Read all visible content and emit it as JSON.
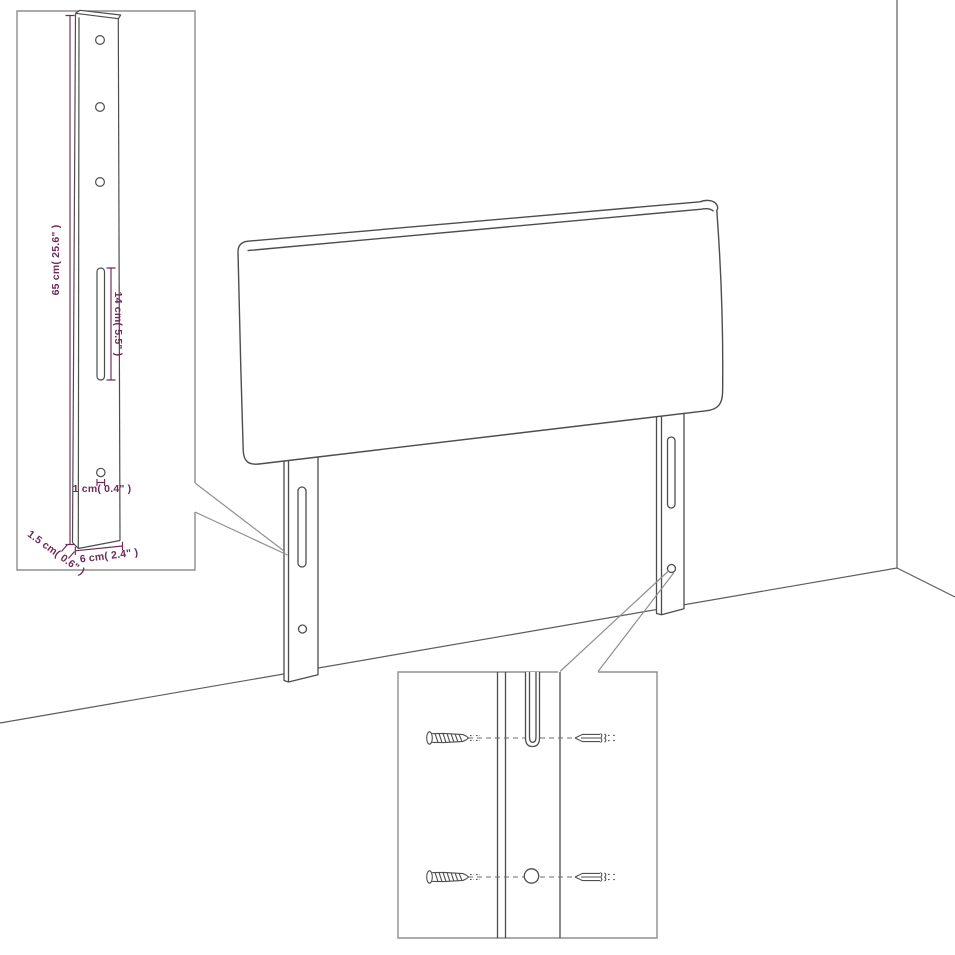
{
  "diagram": {
    "leg_detail_inset": {
      "height_label": "65 cm( 25.6\" )",
      "slot_height_label": "14 cm( 5.5\" )",
      "hole_diameter_label": "1 cm( 0.4\" )",
      "thickness_label": "1.5 cm( 0.6\" )",
      "width_label": "6 cm( 2.4\" )"
    },
    "colors": {
      "outline": "#4d4d4d",
      "wall_line": "#5c5c5c",
      "inset_border": "#8f8f8f",
      "callout_line": "#8f8f8f",
      "dimension": "#6d2a5a",
      "background": "#ffffff"
    },
    "icons": [
      "wood-screw-icon",
      "machine-screw-icon"
    ]
  }
}
